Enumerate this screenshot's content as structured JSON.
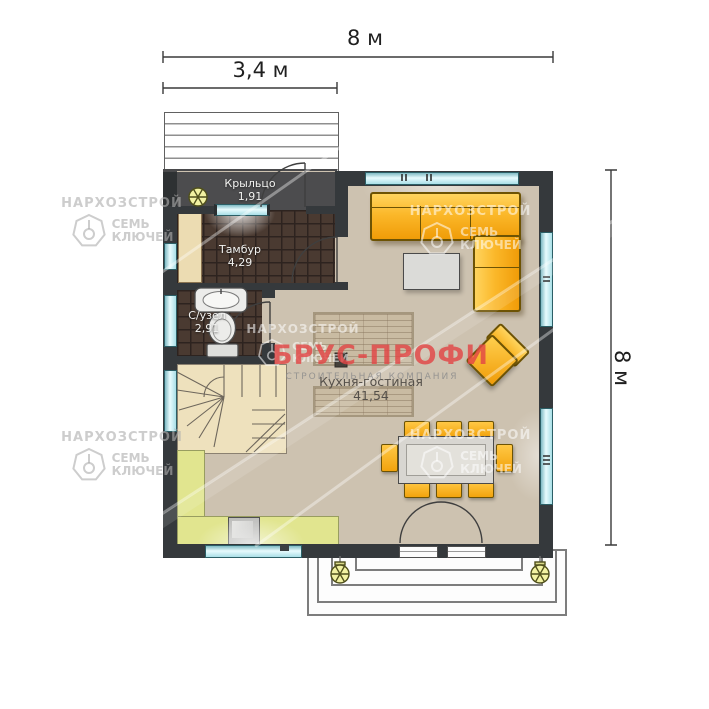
{
  "dimensions": {
    "top_width": "8 м",
    "top_partial": "3,4 м",
    "right_height": "8 м"
  },
  "rooms": [
    {
      "name": "Крыльцо",
      "area": "1,91"
    },
    {
      "name": "Тамбур",
      "area": "4,29"
    },
    {
      "name": "С/узел",
      "area": "2,91"
    },
    {
      "name": "Кухня-гостиная",
      "area": "41,54"
    }
  ],
  "watermark": {
    "brand": "БРУС-ПРОФИ",
    "brand_sub": "СТРОИТЕЛЬНАЯ КОМПАНИЯ",
    "stamp_line1": "НАРХОЗСТРОЙ",
    "stamp_word1": "СЕМЬ",
    "stamp_word2": "КЛЮЧЕЙ"
  },
  "colors": {
    "wall": "#35393c",
    "floor": "#cdc2b0",
    "tile_floor": "#4a3a31",
    "sofa_orange": "#f7a91c",
    "window_glass": "#c6ebf1",
    "kitchen_counter": "#e1e58f",
    "brand_red": "#e24646",
    "stairs": "#eee1bd"
  },
  "icons": {
    "ceiling_light": "flower-light-symbol",
    "stamp_logo": "heptagon-key"
  }
}
